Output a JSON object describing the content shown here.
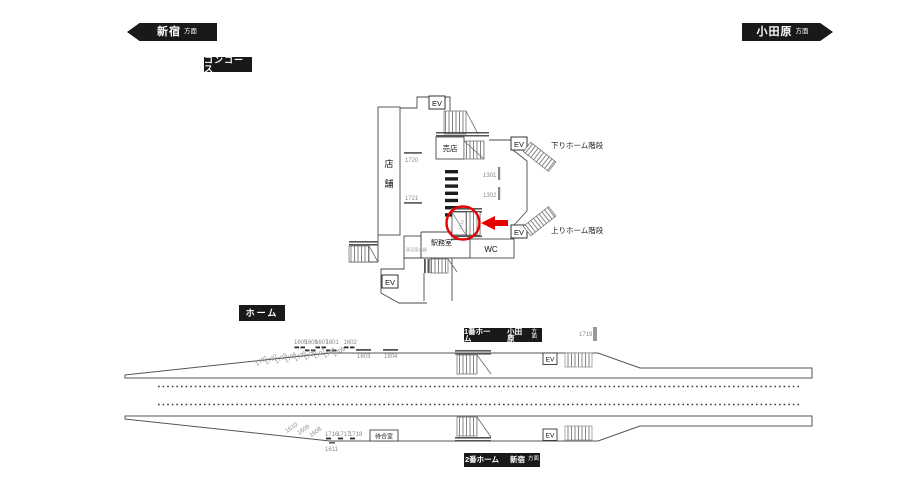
{
  "colors": {
    "badge_bg": "#191919",
    "line": "#4a4a4a",
    "accent_red": "#e60000",
    "number_gray": "#8a8a8a"
  },
  "direction_badges": {
    "left": {
      "name": "新宿",
      "suffix": "方面"
    },
    "right": {
      "name": "小田原",
      "suffix": "方面"
    }
  },
  "section_labels": {
    "concourse": "コンコース",
    "platform": "ホーム"
  },
  "platform_badges": {
    "p1": {
      "platform": "1番ホーム",
      "dest": "小田原",
      "suffix": "方面"
    },
    "p2": {
      "platform": "2番ホーム",
      "dest": "新宿",
      "suffix": "方面"
    }
  },
  "concourse": {
    "elevator": "EV",
    "kiosk": "売店",
    "store_label": [
      "店",
      "舗"
    ],
    "office": "駅務室",
    "toilet": "WC",
    "info_sign": "周辺案内図",
    "stairs_down_label": "下りホーム階段",
    "stairs_up_label": "上りホーム階段",
    "ad_numbers": {
      "n1720": "1720",
      "n1721": "1721",
      "n1301": "1301",
      "n1302": "1302"
    },
    "highlighted_number": "1612"
  },
  "platform1": {
    "elevator": "EV",
    "top_row_numbers": [
      "1605",
      "1606",
      "1607",
      "1601",
      "1602"
    ],
    "overline_numbers": [
      "1603",
      "1604"
    ],
    "angled_numbers": [
      "1701",
      "1702",
      "1703",
      "1704",
      "1705",
      "1706",
      "1707",
      "1708",
      "1709"
    ],
    "right_number": "1719"
  },
  "platform2": {
    "elevator": "EV",
    "angled_numbers": [
      "1610",
      "1609",
      "1608"
    ],
    "flat_numbers": [
      "1716",
      "1717",
      "1718"
    ],
    "below_number": "1611",
    "waiting_room": "待合室"
  }
}
